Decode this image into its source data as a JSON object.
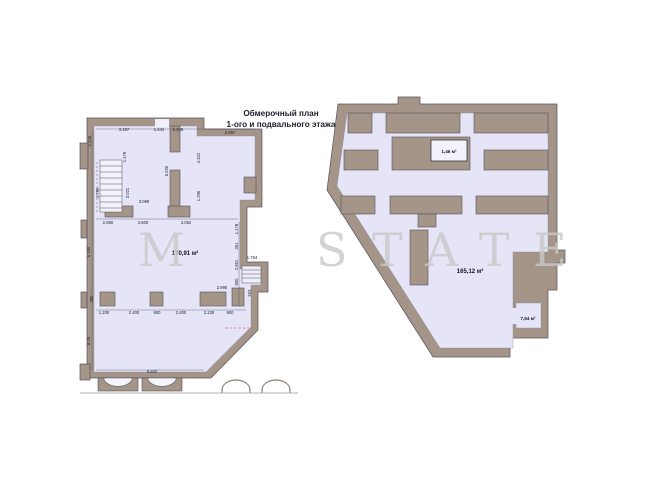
{
  "title": {
    "line1": "Обмерочный план",
    "line2": "1-ого и подвального этажа"
  },
  "watermark": {
    "letters": [
      "M",
      "S",
      "T",
      "A",
      "T",
      "E"
    ]
  },
  "colors": {
    "wall": "#a49588",
    "wall_edge": "#56515c",
    "floor": "#e5e5f7",
    "dim_text": "#1c1c30",
    "red_dash": "#d98c8c",
    "watermark": "#c9c9c9",
    "background": "#ffffff"
  },
  "first_floor_plan": {
    "area_label": "170,91 м²",
    "dims": [
      "3.487",
      "1.441",
      "1.348",
      "2.997",
      "3.099",
      "2.960",
      "2.600",
      "3.052",
      "1.754",
      "2.995",
      "1.200",
      "2.400",
      "900",
      "2.400",
      "2.230",
      "900",
      "6.502",
      "1.245",
      "1.479",
      "4.785",
      "3.021",
      "6.026",
      "4.322",
      "1.296",
      "6.150",
      "1.178",
      "361",
      "2.861",
      "900",
      "553",
      "280",
      "8.26"
    ]
  },
  "basement_plan": {
    "room_labels": [
      "1,46 м²",
      "165,12 м²",
      "7,54 м²"
    ]
  }
}
